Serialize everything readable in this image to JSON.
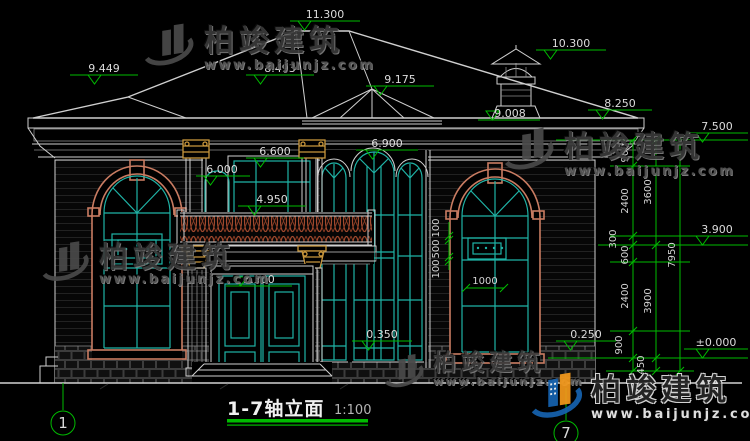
{
  "colors": {
    "background": "#000000",
    "drawing_line": "#cfcfcf",
    "dimension_green": "#00bb00",
    "dimension_text": "#dcdcdc",
    "window_teal": "#1fb3a6",
    "frame_salmon": "#c97c62",
    "capital_gold": "#c8963c",
    "baluster_brown": "#a34a2e",
    "watermark_gray": "#3a3a3a",
    "logo_blue": "#1663b0",
    "logo_orange": "#f59a1c"
  },
  "title": {
    "text": "1-7轴立面",
    "scale": "1:100"
  },
  "watermark": {
    "brand": "柏竣建筑",
    "url": "www.baijunjz.com"
  },
  "axes": {
    "left": "1",
    "right": "7"
  },
  "elevations": {
    "ridge": "11.300",
    "cupola": "10.300",
    "left_roof": "9.449",
    "mid_roof": "8.493",
    "bay_hip": "9.175",
    "bay_eave": "9.008",
    "right_eave": "8.250",
    "wall_top": "7.500",
    "tall_window_top": "6.900",
    "f2_window_top": "6.600",
    "f2_side_window": "6.000",
    "balcony_rail": "4.950",
    "f2_floor": "3.900",
    "door_top": "3.300",
    "sill_low": "0.350",
    "plinth": "0.250",
    "ground": "±0.000"
  },
  "dim_chains": {
    "outer_total": "7950",
    "floors": [
      "3600",
      "3900"
    ],
    "segments": [
      "900",
      "2400",
      "300",
      "600",
      "2400",
      "900",
      "450"
    ],
    "window_heights": [
      "100",
      "500",
      "100"
    ],
    "window_width": "1000"
  }
}
